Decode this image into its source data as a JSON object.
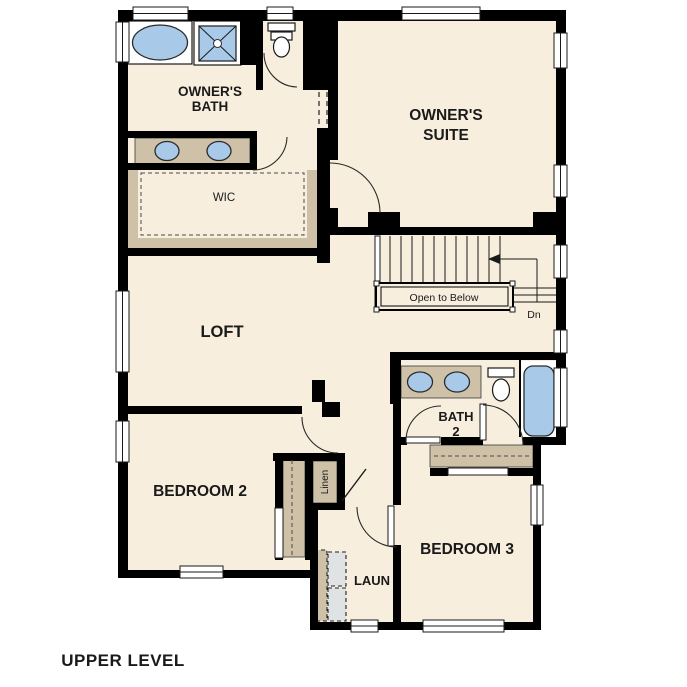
{
  "page_title": "UPPER LEVEL",
  "colors": {
    "background": "#ffffff",
    "wall": "#000000",
    "floor": "#f7eede",
    "cabinetry": "#cec1a7",
    "fixture": "#a9c9e9",
    "appliance": "#dfe3e4"
  },
  "rooms": {
    "owners_bath": {
      "line1": "OWNER'S",
      "line2": "BATH"
    },
    "owners_suite": {
      "line1": "OWNER'S",
      "line2": "SUITE"
    },
    "wic": {
      "label": "WIC"
    },
    "loft": {
      "label": "LOFT"
    },
    "bath2": {
      "line1": "BATH",
      "line2": "2"
    },
    "bedroom2": {
      "label": "BEDROOM 2"
    },
    "bedroom3": {
      "label": "BEDROOM 3"
    },
    "laundry": {
      "label": "LAUN"
    },
    "linen": {
      "label": "Linen"
    }
  },
  "stairs": {
    "open_to_below": "Open to Below",
    "down": "Dn"
  }
}
